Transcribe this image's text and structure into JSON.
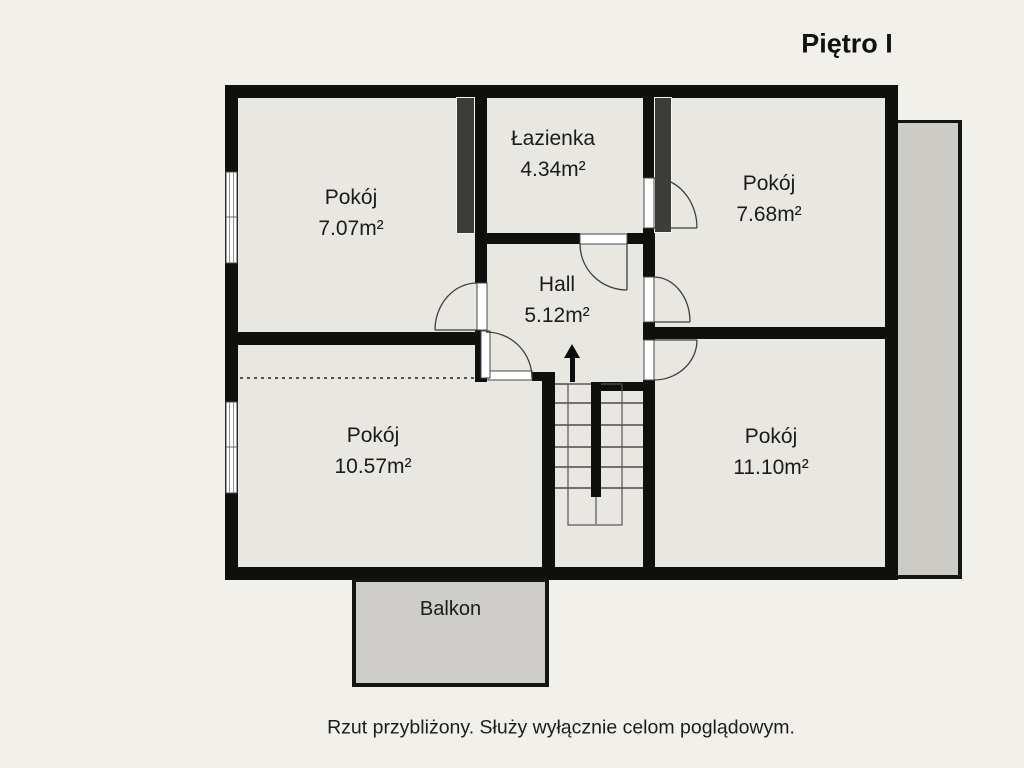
{
  "title": "Piętro I",
  "rooms": [
    {
      "label": "Pokój",
      "area": "7.07m²"
    },
    {
      "label": "Łazienka",
      "area": "4.34m²"
    },
    {
      "label": "Pokój",
      "area": "7.68m²"
    },
    {
      "label": "Hall",
      "area": "5.12m²"
    },
    {
      "label": "Pokój",
      "area": "10.57m²"
    },
    {
      "label": "Pokój",
      "area": "11.10m²"
    }
  ],
  "balcony": {
    "label": "Balkon"
  },
  "caption": "Rzut przybliżony. Służy wyłącznie celom poglądowym.",
  "colors": {
    "background": "#f2f0eb",
    "room_fill": "#e9e7e1",
    "wall": "#0f0f0d",
    "duct": "#3c3c3a",
    "terrace_fill": "#cccbc6",
    "balcony_fill": "#cecdc9",
    "text": "#1b1b1b"
  }
}
